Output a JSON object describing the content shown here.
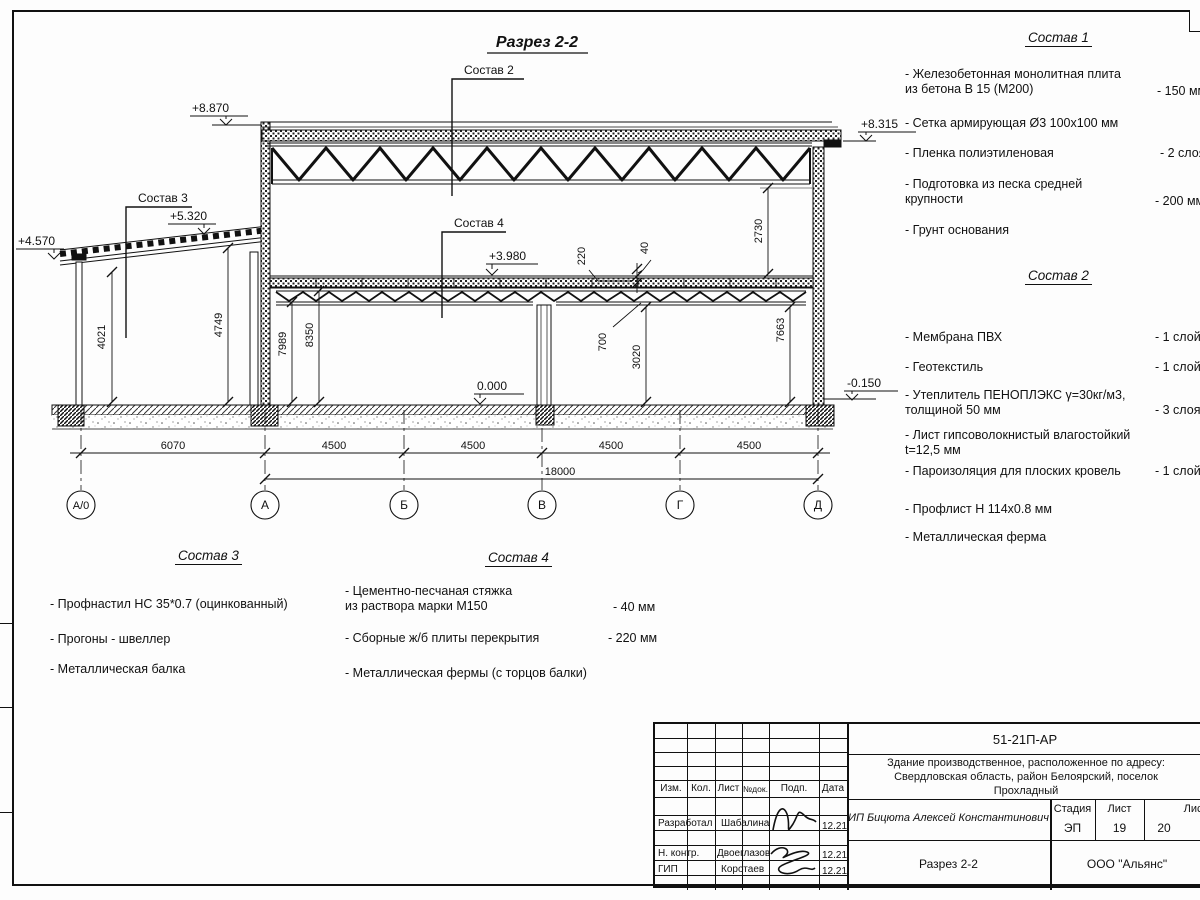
{
  "drawing": {
    "title": "Разрез 2-2",
    "callouts": {
      "c2": "Состав 2",
      "c3": "Состав 3",
      "c4": "Состав 4"
    },
    "elevations": {
      "roof_left": "+8.870",
      "roof_right": "+8.315",
      "annex_eave": "+4.570",
      "annex_top": "+5.320",
      "floor2": "+3.980",
      "floor0": "0.000",
      "ground": "-0.150"
    },
    "vdims": {
      "annex_left": "4021",
      "annex_right": "4749",
      "hall_a": "7989",
      "hall_b": "8350",
      "roof_zone": "2730",
      "hall_right": "7663",
      "slab": "220",
      "screed": "40",
      "truss": "700",
      "clear": "3020"
    },
    "hdims": {
      "bay0": "6070",
      "bay": "4500",
      "total": "18000"
    },
    "axes": [
      "А/0",
      "А",
      "Б",
      "В",
      "Г",
      "Д"
    ]
  },
  "lists": {
    "sostav1": {
      "title": "Состав 1",
      "items": [
        {
          "text": "- Железобетонная  монолитная плита\nиз бетона В 15 (М200)",
          "value": "- 150 мм"
        },
        {
          "text": "- Сетка армирующая Ø3 100х100 мм",
          "value": ""
        },
        {
          "text": "- Пленка полиэтиленовая",
          "value": "- 2 слоя"
        },
        {
          "text": "- Подготовка из песка средней\nкрупности",
          "value": "- 200 мм"
        },
        {
          "text": "- Грунт основания",
          "value": ""
        }
      ]
    },
    "sostav2": {
      "title": "Состав 2",
      "items": [
        {
          "text": "- Мембрана ПВХ",
          "value": "- 1 слой"
        },
        {
          "text": "- Геотекстиль",
          "value": "- 1 слой"
        },
        {
          "text": "- Утеплитель ПЕНОПЛЭКС γ=30кг/м3,\nтолщиной 50 мм",
          "value": "- 3 слоя"
        },
        {
          "text": "- Лист гипсоволокнистый влагостойкий\nt=12,5 мм",
          "value": ""
        },
        {
          "text": "- Пароизоляция для плоских кровель",
          "value": "- 1 слой"
        },
        {
          "text": "- Профлист Н 114х0.8 мм",
          "value": ""
        },
        {
          "text": "- Металлическая ферма",
          "value": ""
        }
      ]
    },
    "sostav3": {
      "title": "Состав 3",
      "items": [
        {
          "text": "- Профнастил НС 35*0.7 (оцинкованный)"
        },
        {
          "text": "- Прогоны - швеллер"
        },
        {
          "text": "- Металлическая балка"
        }
      ]
    },
    "sostav4": {
      "title": "Состав 4",
      "items": [
        {
          "text": "- Цементно-песчаная стяжка\nиз раствора марки М150",
          "value": "- 40 мм"
        },
        {
          "text": "- Сборные ж/б плиты перекрытия",
          "value": "- 220 мм"
        },
        {
          "text": "- Металлическая фермы (с торцов балки)",
          "value": ""
        }
      ]
    }
  },
  "titleblock": {
    "doc_number": "51-21П-АР",
    "object": "Здание производственное, расположенное по адресу:\nСвердловская область, район Белоярский, поселок\nПрохладный",
    "header": {
      "izm": "Изм.",
      "kol": "Кол.",
      "list": "Лист",
      "ndok": "№док.",
      "podp": "Подп.",
      "data": "Дата"
    },
    "rows": [
      {
        "role": "Разработал",
        "name": "Шабалина",
        "date": "12.21"
      },
      {
        "role": "Н. контр.",
        "name": "Двоеглазов",
        "date": "12.21"
      },
      {
        "role": "ГИП",
        "name": "Коротаев",
        "date": "12.21"
      }
    ],
    "company_line": "ИП Бицюта Алексей Константинович",
    "stage_label": "Стадия",
    "sheet_label": "Лист",
    "sheets_label": "Листов",
    "stage": "ЭП",
    "sheet": "19",
    "sheets": "20",
    "sheet_title": "Разрез 2-2",
    "org": "ООО \"Альянс\""
  }
}
